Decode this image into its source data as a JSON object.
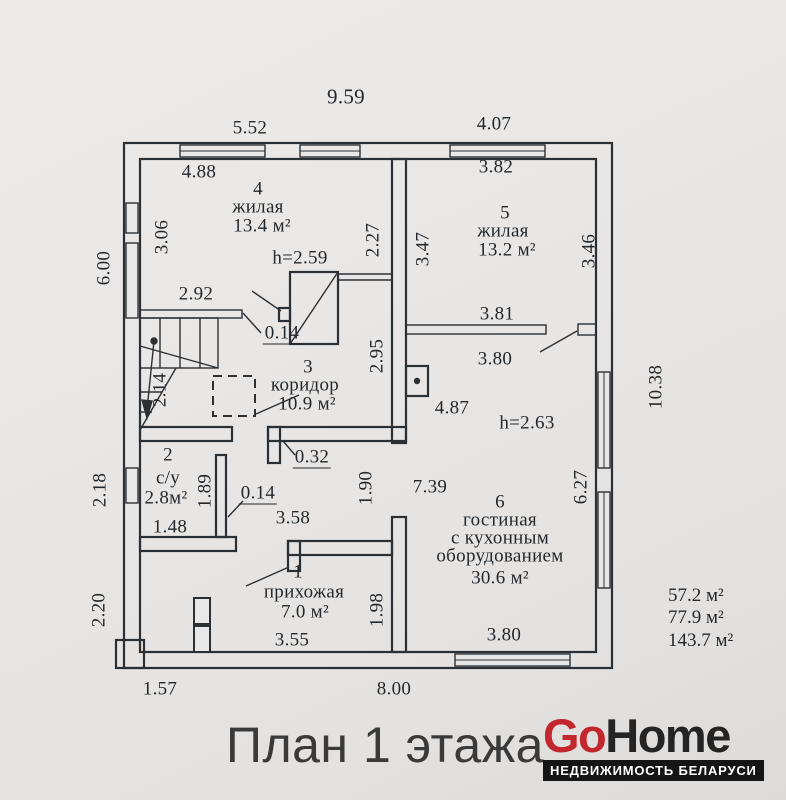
{
  "caption": {
    "title": "План 1 этажа"
  },
  "logo": {
    "go": "Go",
    "home": "Home",
    "tagline": "НЕДВИЖИМОСТЬ БЕЛАРУСИ",
    "go_color": "#c2272d",
    "home_color": "#242424"
  },
  "totals": {
    "living_area": "57.2 м²",
    "usable_area": "77.9 м²",
    "total_area": "143.7 м²"
  },
  "rooms": {
    "r1": {
      "num": "1",
      "name": "прихожая",
      "area": "7.0 м²"
    },
    "r2": {
      "num": "2",
      "name": "с/у",
      "area": "2.8м²"
    },
    "r3": {
      "num": "3",
      "name": "коридор",
      "area": "10.9 м²"
    },
    "r4": {
      "num": "4",
      "name": "жилая",
      "area": "13.4 м²",
      "height": "h=2.59"
    },
    "r5": {
      "num": "5",
      "name": "жилая",
      "area": "13.2 м²"
    },
    "r6": {
      "num": "6",
      "name_line1": "гостиная",
      "name_line2": "с кухонным",
      "name_line3": "оборудованием",
      "area": "30.6 м²",
      "height": "h=2.63"
    }
  },
  "dims": {
    "top_total": "9.59",
    "top_left_span": "5.52",
    "top_right_span": "4.07",
    "r4_top": "4.88",
    "r5_top": "3.82",
    "left_upper": "6.00",
    "r4_left": "3.06",
    "r4_right": "2.27",
    "r5_left": "3.47",
    "r5_right": "3.46",
    "stairs_shelf": "2.92",
    "shelf_thickness": "0.14",
    "stairs_height": "2.14",
    "r3_right": "2.95",
    "r3_bottom": "4.87",
    "r5_partition_top": "3.81",
    "r5_partition_bottom": "3.80",
    "right_total": "10.38",
    "r6_width": "7.39",
    "r6_right": "6.27",
    "r6_bottom_window": "3.80",
    "wall_032": "0.32",
    "su_wall_014": "0.14",
    "su_door": "1.89",
    "su_bottom": "1.48",
    "left_middle": "2.18",
    "left_lower": "2.20",
    "hall_opening_top": "3.58",
    "hall_opening_right": "1.90",
    "r1_bottom": "3.55",
    "r1_right": "1.98",
    "bottom_left_span": "1.57",
    "bottom_total": "8.00"
  }
}
